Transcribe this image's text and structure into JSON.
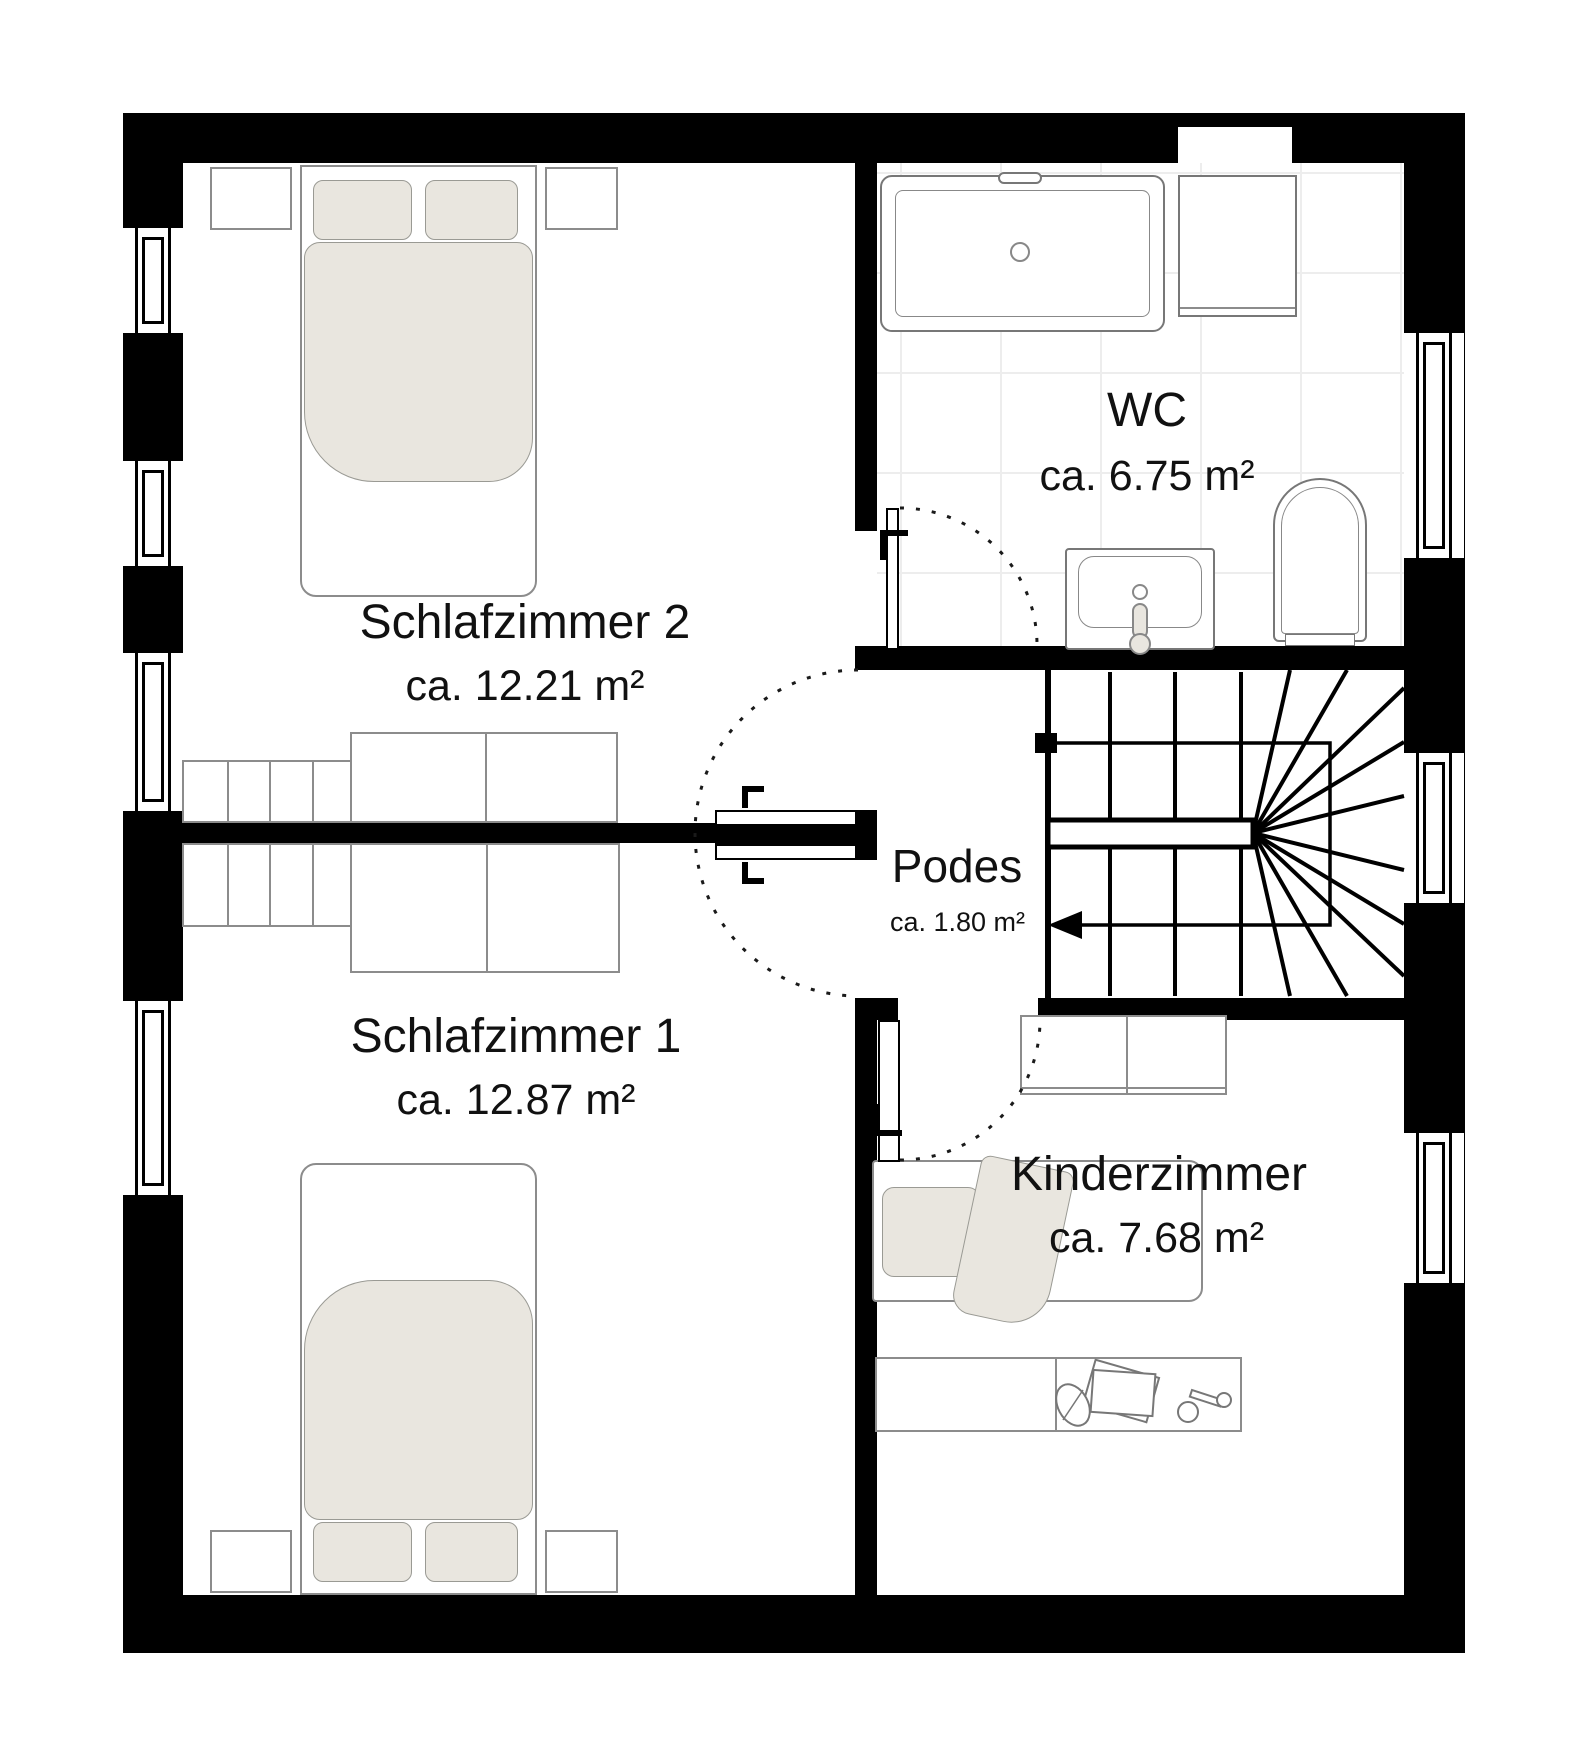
{
  "plan": {
    "type": "floorplan",
    "rooms": [
      {
        "key": "schlafzimmer2",
        "name": "Schlafzimmer 2",
        "area": "ca. 12.21 m²"
      },
      {
        "key": "wc",
        "name": "WC",
        "area": "ca. 6.75 m²"
      },
      {
        "key": "podest",
        "name": "Podes",
        "area": "ca. 1.80 m²"
      },
      {
        "key": "schlafzimmer1",
        "name": "Schlafzimmer 1",
        "area": "ca. 12.87 m²"
      },
      {
        "key": "kinderzimmer",
        "name": "Kinderzimmer",
        "area": "ca. 7.68 m²"
      }
    ],
    "colors": {
      "wall": "#000000",
      "textile": "#e9e6df",
      "furniture_outline": "#8c8c8c",
      "tile_line": "#ededed",
      "text": "#111111",
      "door_arc": "#1a1a1a"
    },
    "icons": [
      "double-bed-icon",
      "pillow-icon",
      "duvet-icon",
      "nightstand-icon",
      "wardrobe-icon",
      "dresser-icon",
      "bathtub-icon",
      "vanity-cabinet-icon",
      "washbasin-icon",
      "toilet-icon",
      "single-bed-icon",
      "blanket-icon",
      "desk-icon",
      "paper-sheets-icon",
      "desk-lamp-icon",
      "leaf-icon",
      "stairs-icon",
      "handrail-icon",
      "walk-direction-arrow-icon",
      "door-leaf-icon",
      "door-swing-arc-icon",
      "window-icon"
    ]
  }
}
